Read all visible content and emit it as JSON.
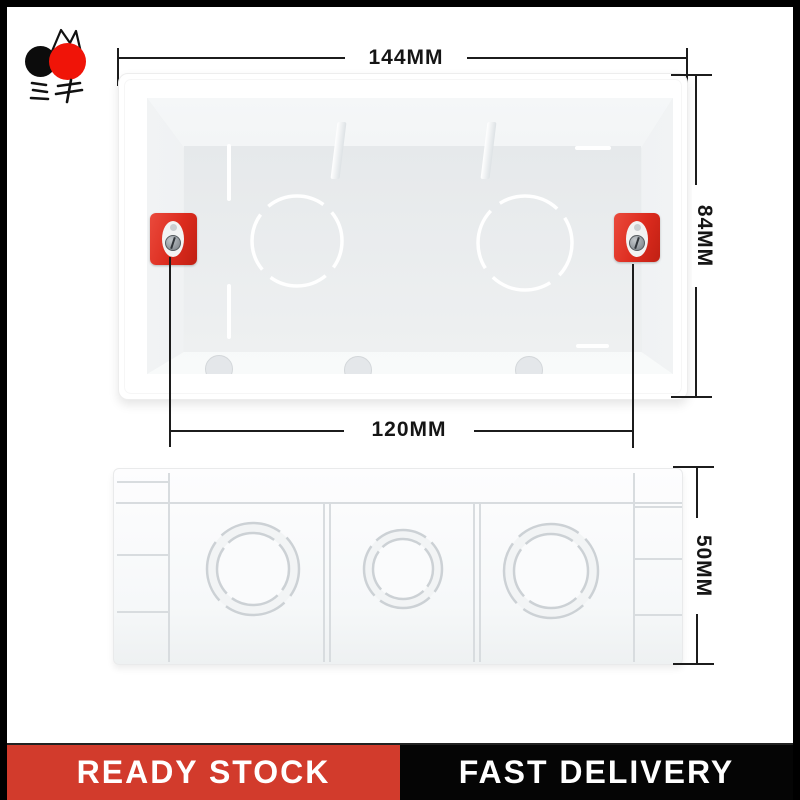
{
  "logo": {
    "text": "ミキ",
    "icon": "cherries-logo"
  },
  "product": {
    "type": "wall mounting box",
    "views": [
      "front-open-view",
      "back-view"
    ]
  },
  "dimensions": {
    "top_width": "144MM",
    "height": "84MM",
    "inner_width": "120MM",
    "depth": "50MM"
  },
  "banner": {
    "left": "READY STOCK",
    "right": "FAST DELIVERY"
  },
  "colors": {
    "banner-red": "#d23b2c",
    "banner-black": "#050505",
    "clamp-red": "#dc2b1e",
    "logo-red": "#f01408",
    "logo-black": "#0c0c0c",
    "dim-line": "#1c1c1c",
    "rib-gray": "#d8dcdf",
    "ring-gray": "#ccd1d5"
  }
}
